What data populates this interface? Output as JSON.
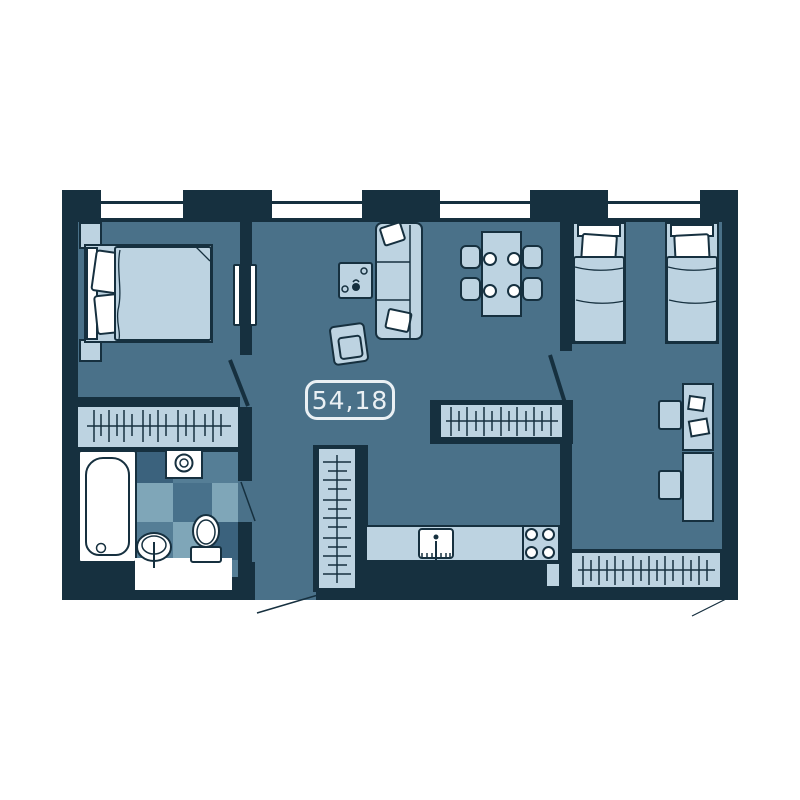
{
  "plan": {
    "area_label": "54,18",
    "colors": {
      "background": "#FFFFFF",
      "wall": "#16303F",
      "floor": "#4A7189",
      "furniture": "#BDD3E1",
      "outline": "#16303F",
      "white": "#FFFFFF",
      "tile_light": "#7FA6B8",
      "tile_mid": "#557E96",
      "tile_base": "#48718B",
      "tile_dark": "#3B627D",
      "label": "#EAF0F4"
    },
    "furniture": [
      "window",
      "double-bed",
      "nightstand",
      "wardrobe-hangers",
      "sliding-door",
      "sofa",
      "pillow",
      "coffee-table",
      "armchair",
      "dining-table",
      "dining-chair",
      "plate",
      "kitchen-counter",
      "kitchen-sink",
      "stove",
      "tall-wardrobe",
      "bathtub",
      "washing-machine",
      "bathroom-sink",
      "toilet",
      "vanity-counter",
      "single-bed",
      "desk",
      "desk-chair",
      "paper-sheet",
      "door-swing",
      "entrance-door-swing"
    ]
  }
}
